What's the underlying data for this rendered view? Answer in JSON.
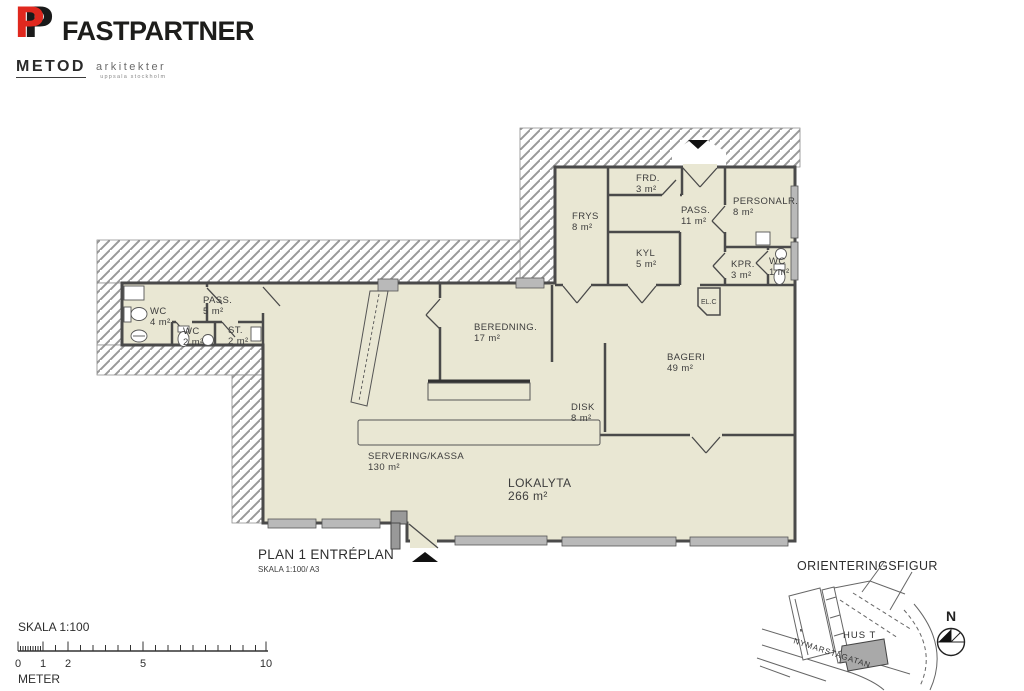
{
  "branding": {
    "logo_glyph": "P",
    "company": "FASTPARTNER",
    "studio": "METOD",
    "studio_suffix": "arkitekter",
    "studio_sub": "uppsala stockholm"
  },
  "plan": {
    "title": "PLAN 1 ENTRÉPLAN",
    "subtitle": "SKALA 1:100/ A3",
    "utility_label": "EL.C",
    "rooms": [
      {
        "name": "WC",
        "area": "4 m²",
        "x": 150,
        "y": 314
      },
      {
        "name": "PASS.",
        "area": "5 m²",
        "x": 203,
        "y": 303
      },
      {
        "name": "WC",
        "area": "2 m²",
        "x": 183,
        "y": 334
      },
      {
        "name": "ST.",
        "area": "2 m²",
        "x": 228,
        "y": 333
      },
      {
        "name": "FRYS",
        "area": "8 m²",
        "x": 572,
        "y": 219
      },
      {
        "name": "FRD.",
        "area": "3 m²",
        "x": 636,
        "y": 181
      },
      {
        "name": "PASS.",
        "area": "11 m²",
        "x": 681,
        "y": 213
      },
      {
        "name": "PERSONALR.",
        "area": "8 m²",
        "x": 733,
        "y": 204
      },
      {
        "name": "KYL",
        "area": "5 m²",
        "x": 636,
        "y": 256
      },
      {
        "name": "KPR.",
        "area": "3 m²",
        "x": 731,
        "y": 267
      },
      {
        "name": "WC",
        "area": "1 m²",
        "x": 769,
        "y": 264
      },
      {
        "name": "BEREDNING.",
        "area": "17 m²",
        "x": 474,
        "y": 330
      },
      {
        "name": "BAGERI",
        "area": "49 m²",
        "x": 667,
        "y": 360
      },
      {
        "name": "DISK",
        "area": "8 m²",
        "x": 571,
        "y": 410
      },
      {
        "name": "SERVERING/KASSA",
        "area": "130 m²",
        "x": 368,
        "y": 459
      },
      {
        "name": "LOKALYTA",
        "area": "266 m²",
        "x": 508,
        "y": 487,
        "size": 12
      }
    ]
  },
  "scalebar": {
    "title": "SKALA 1:100",
    "unit": "METER",
    "marks": [
      {
        "label": "0",
        "x": 18
      },
      {
        "label": "1",
        "x": 43
      },
      {
        "label": "2",
        "x": 68
      },
      {
        "label": "5",
        "x": 143
      },
      {
        "label": "10",
        "x": 266
      }
    ]
  },
  "orientation": {
    "title": "ORIENTERINGSFIGUR",
    "building": "HUS T",
    "street": "NYMARSTAGATAN",
    "north": "N"
  },
  "colors": {
    "accent": "#e0281e",
    "interior": "#e9e7d3",
    "hatch": "#9a9a9a",
    "wall": "#4a4a4a",
    "window": "#b9b9b9",
    "text": "#3d3d3d"
  }
}
